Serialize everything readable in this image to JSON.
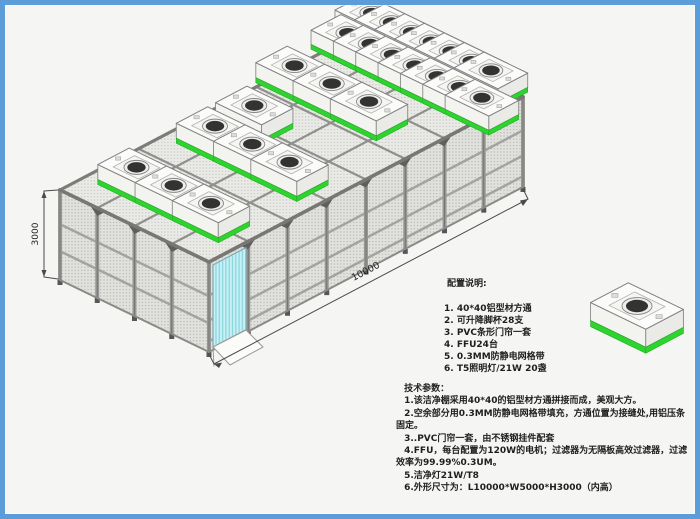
{
  "colors": {
    "border_blue": "#5b9dd8",
    "background": "#f5f5f3",
    "ffu_green": "#2fd32f",
    "ffu_green_dark": "#1fae1f",
    "door_cyan": "#c9f0f5",
    "door_stripe": "#8ed8e2",
    "frame_gray": "#8f8f8c",
    "beam_dark": "#7c7c79",
    "dim_line": "#4a4a4a",
    "fan_dark": "#333333",
    "text_dark": "#1f1f1f"
  },
  "diagram": {
    "height_dimension_label": "3000",
    "length_dimension_label": "10000"
  },
  "config_notes": {
    "title": "配置说明:",
    "items": [
      "1. 40*40铝型材方通",
      "2. 可升降脚杯28支",
      "3. PVC条形门帘一套",
      "4. FFU24台",
      "5. 0.3MM防静电网格带",
      "6. T5照明灯/21W 20盏"
    ]
  },
  "tech_params": {
    "title": "技术参数：",
    "items": [
      "1.该洁净棚采用40*40的铝型材方通拼接而成，美观大方。",
      "2.空余部分用0.3MM防静电网格带填充，方通位置为接缝处,用铝压条固定。",
      "3..PVC门帘一套，由不锈钢挂件配套",
      "4.FFU，每台配置为120W的电机；过滤器为无隔板高效过滤器，过滤效率为99.99%0.3UM。",
      "5.洁净灯21W/T8",
      "6.外形尺寸为：L10000*W5000*H3000（内高）"
    ]
  },
  "legend": {
    "ffu_icon_name": "ffu-unit-icon"
  }
}
